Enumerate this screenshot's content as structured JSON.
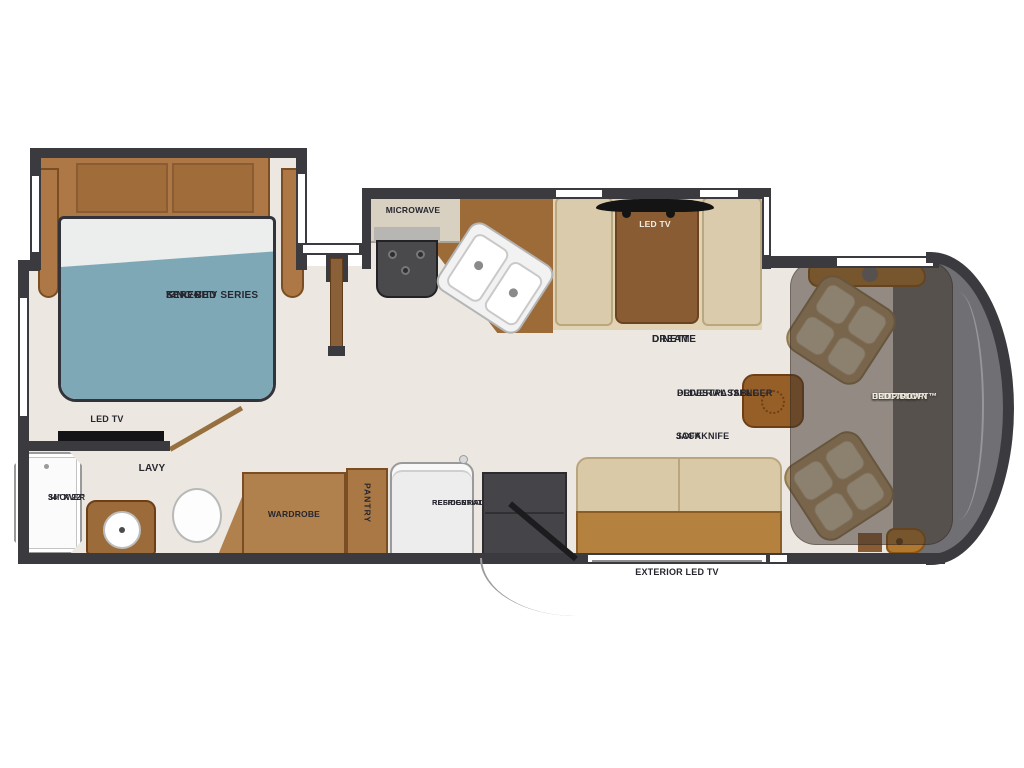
{
  "diagram_title": "Class A motorhome floor plan",
  "colors": {
    "wall": "#3b3a3e",
    "floor": "#ece8e1",
    "wood": "#ad7845",
    "wood_dark": "#8a5c33",
    "counter": "#9c6b38",
    "bed_blue": "#7fa8b6",
    "bench_tan": "#d9c9a7",
    "label_text": "#26262e",
    "label_text_light": "#f3eee2"
  },
  "bedroom": {
    "bed_line1": "SERENITY SERIES",
    "bed_line2": "KING BED",
    "bed_line3": "72\" x 74\"",
    "tv": "LED TV"
  },
  "bathroom": {
    "room": "LAVY",
    "shower_line1": "SHOWER",
    "shower_line2": "34\" X 22\""
  },
  "storage": {
    "wardrobe": "WARDROBE",
    "pantry": "PANTRY",
    "fridge_line1": "RESIDENTIAL",
    "fridge_line2": "REFRIGERATOR"
  },
  "kitchen": {
    "microwave": "MICROWAVE"
  },
  "dinette": {
    "tv": "LED TV",
    "line1": "DREAM",
    "line2": "DINETTE"
  },
  "living": {
    "table_line1": "DRIVER/PASSENGER",
    "table_line2": "PEDESTAL TABLE",
    "sofa_line1": "JACKKNIFE",
    "sofa_line2": "SOFA",
    "exterior_tv": "EXTERIOR LED TV"
  },
  "cab": {
    "loft_line1": "HIDE-A-LOFT™",
    "loft_line2": "ELECTRIC",
    "loft_line3": "DROP DOWN",
    "loft_line4": "BED"
  }
}
